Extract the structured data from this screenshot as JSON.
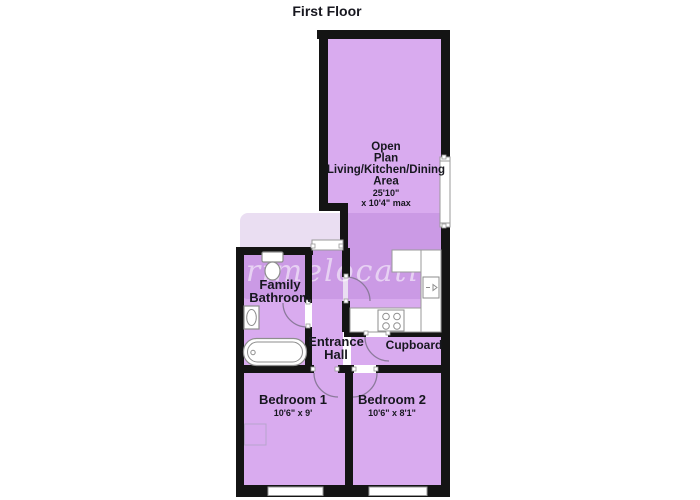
{
  "title": "First Floor",
  "watermark": "primelocation",
  "rooms": {
    "open_plan": {
      "line1": "Open",
      "line2": "Plan",
      "line3": "Living/Kitchen/Dining",
      "line4": "Area",
      "dim1": "25'10\"",
      "dim2": "x 10'4\" max"
    },
    "bathroom": {
      "line1": "Family",
      "line2": "Bathroom"
    },
    "hall": {
      "line1": "Entrance",
      "line2": "Hall"
    },
    "cupboard": {
      "label": "Cupboard"
    },
    "bedroom1": {
      "label": "Bedroom 1",
      "dims": "10'6\" x 9'"
    },
    "bedroom2": {
      "label": "Bedroom 2",
      "dims": "10'6\" x 8'1\""
    }
  },
  "colors": {
    "floor": "#d9abef",
    "band": "rgba(150,90,190,0.20)",
    "wall": "#141414",
    "text": "#17171f",
    "fixture": "#8e8e8e",
    "arc": "#8b7a9b",
    "window": "#9a9a9a",
    "light": "#b8a4cc",
    "white": "#ffffff",
    "watermark": "rgba(255,255,255,0.55)"
  }
}
